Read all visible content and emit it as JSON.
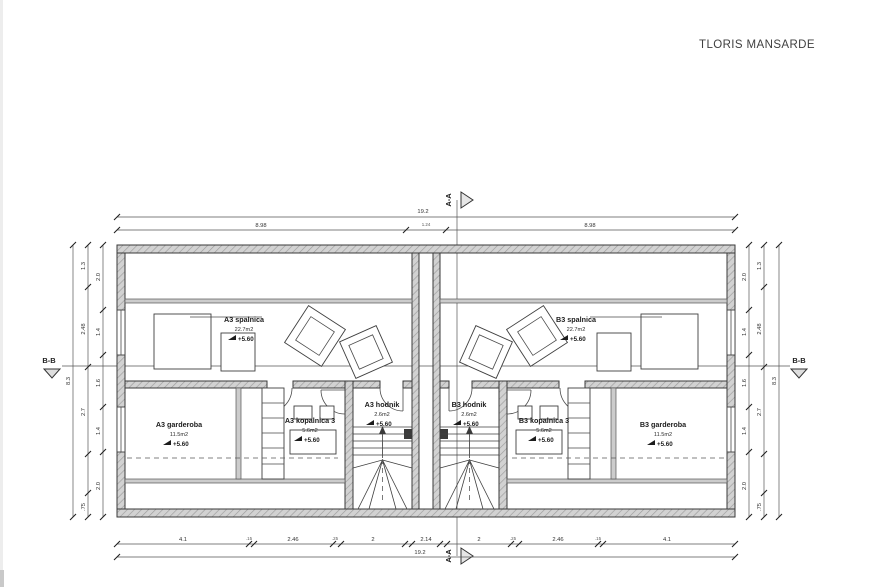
{
  "title": "TLORIS MANSARDE",
  "colors": {
    "line": "#3a3a3a",
    "wall_fill": "#d2d2d2",
    "paper": "#ffffff",
    "accent": "#222222"
  },
  "rooms": {
    "spalnica_a": {
      "name": "A3 spalnica",
      "area": "22.7m2",
      "level": "+5.60"
    },
    "spalnica_b": {
      "name": "B3 spalnica",
      "area": "22.7m2",
      "level": "+5.60"
    },
    "garderoba_a": {
      "name": "A3 garderoba",
      "area": "11.5m2",
      "level": "+5.60"
    },
    "garderoba_b": {
      "name": "B3 garderoba",
      "area": "11.5m2",
      "level": "+5.60"
    },
    "kopalnica_a": {
      "name": "A3 kopalnica 3",
      "area": "5.6m2",
      "level": "+5.60"
    },
    "kopalnica_b": {
      "name": "B3 kopalnica 3",
      "area": "5.6m2",
      "level": "+5.60"
    },
    "hodnik_a": {
      "name": "A3 hodnik",
      "area": "2.6m2",
      "level": "+5.60"
    },
    "hodnik_b": {
      "name": "B3 hodnik",
      "area": "2.6m2",
      "level": "+5.60"
    }
  },
  "sections": {
    "aa": "A-A",
    "bb": "B-B"
  },
  "dims": {
    "overall_w": "19.2",
    "overall_h": "8.3",
    "top_left": "8.98",
    "top_center": "1.24",
    "top_right": "8.98",
    "bottom": [
      "4.1",
      ".15",
      "2.46",
      ".25",
      "2",
      "2.14",
      "2",
      ".25",
      "2.46",
      ".15",
      "4.1"
    ],
    "side_mid": [
      "1.3",
      "2.48",
      "2.7",
      ".75"
    ],
    "side_inner": [
      "2.0",
      "1.4",
      "1.6",
      "1.4",
      "2.0"
    ]
  }
}
